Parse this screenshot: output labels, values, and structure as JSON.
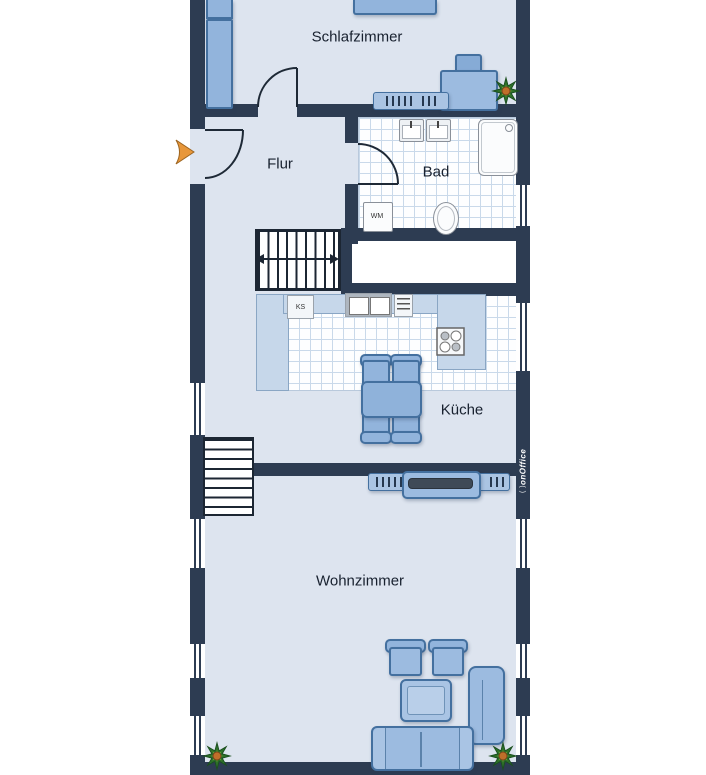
{
  "plan": {
    "type": "floor-plan",
    "watermark": {
      "mark": "( )",
      "brand": "onOffice"
    },
    "rooms": {
      "schlafzimmer": {
        "label": "Schlafzimmer"
      },
      "flur": {
        "label": "Flur"
      },
      "bad": {
        "label": "Bad"
      },
      "kueche": {
        "label": "Küche"
      },
      "wohnzimmer": {
        "label": "Wohnzimmer"
      }
    },
    "appliances": {
      "washing_machine": {
        "label": "WM"
      },
      "fridge": {
        "label": "KS"
      }
    },
    "colors": {
      "wall": "#2d3c52",
      "floor": "#dde4ef",
      "tile_bg": "#fdfeff",
      "tile_line": "#c9d9ea",
      "furniture": "#92b4dc",
      "furniture_border": "#44709f",
      "counter": "#c6d7ea",
      "entry_arrow": "#e8973a",
      "plant": "#2e7b33"
    }
  }
}
